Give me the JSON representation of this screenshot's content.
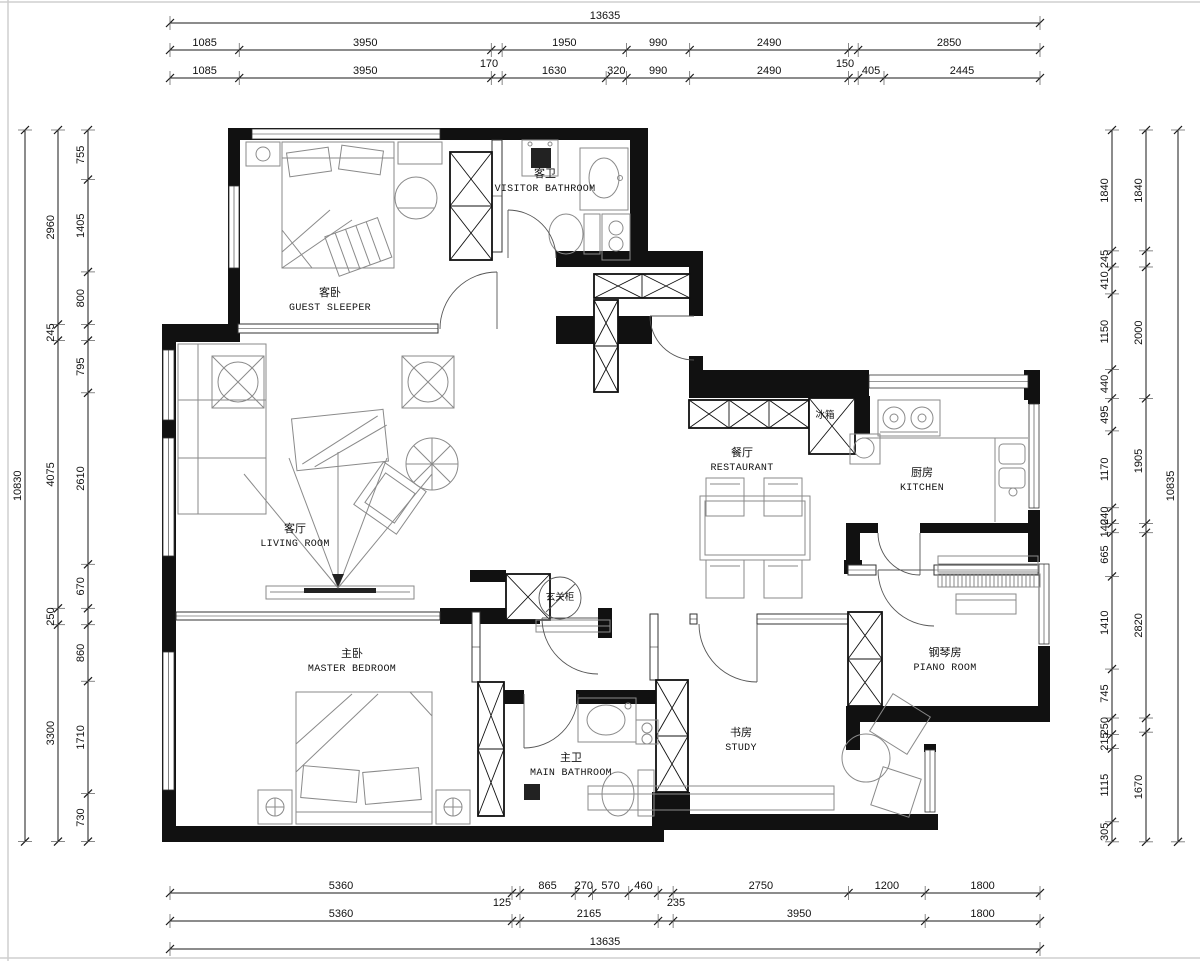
{
  "rooms": {
    "guest_sleeper": {
      "zh": "客卧",
      "en": "GUEST SLEEPER"
    },
    "visitor_bathroom": {
      "zh": "客卫",
      "en": "VISITOR BATHROOM"
    },
    "living_room": {
      "zh": "客厅",
      "en": "LIVING ROOM"
    },
    "master_bedroom": {
      "zh": "主卧",
      "en": "MASTER BEDROOM"
    },
    "main_bathroom": {
      "zh": "主卫",
      "en": "MAIN BATHROOM"
    },
    "restaurant": {
      "zh": "餐厅",
      "en": "RESTAURANT"
    },
    "kitchen": {
      "zh": "厨房",
      "en": "KITCHEN"
    },
    "piano_room": {
      "zh": "钢琴房",
      "en": "PIANO ROOM"
    },
    "study": {
      "zh": "书房",
      "en": "STUDY"
    },
    "fridge": {
      "zh": "冰箱"
    },
    "entry_cabinet": {
      "zh": "玄关柜"
    }
  },
  "dimensions": {
    "top": {
      "row1": [
        13635
      ],
      "row2": [
        1085,
        3950,
        170,
        1950,
        990,
        2490,
        150,
        2850
      ],
      "row3": [
        1085,
        3950,
        170,
        1630,
        320,
        990,
        2490,
        150,
        405,
        2445
      ]
    },
    "bottom": {
      "row1": [
        5360,
        125,
        865,
        270,
        570,
        460,
        235,
        2750,
        1200,
        1800
      ],
      "row2": [
        5360,
        125,
        2165,
        235,
        3950,
        1800
      ],
      "row3": [
        13635
      ]
    },
    "left": {
      "outer": [
        10830
      ],
      "mid": [
        2960,
        245,
        4075,
        250,
        3300
      ],
      "inner": [
        755,
        1405,
        800,
        245,
        795,
        2610,
        670,
        250,
        860,
        1710,
        730
      ]
    },
    "right": {
      "outer": [
        10835
      ],
      "mid": [
        1840,
        245,
        2000,
        1905,
        140,
        2820,
        215,
        1670
      ],
      "inner": [
        1840,
        245,
        410,
        1150,
        440,
        495,
        1170,
        240,
        140,
        665,
        1410,
        745,
        250,
        215,
        1115,
        305
      ]
    }
  },
  "colors": {
    "wall": "#111111",
    "line": "#1a1a1a",
    "furniture": "#8a8a8a"
  }
}
